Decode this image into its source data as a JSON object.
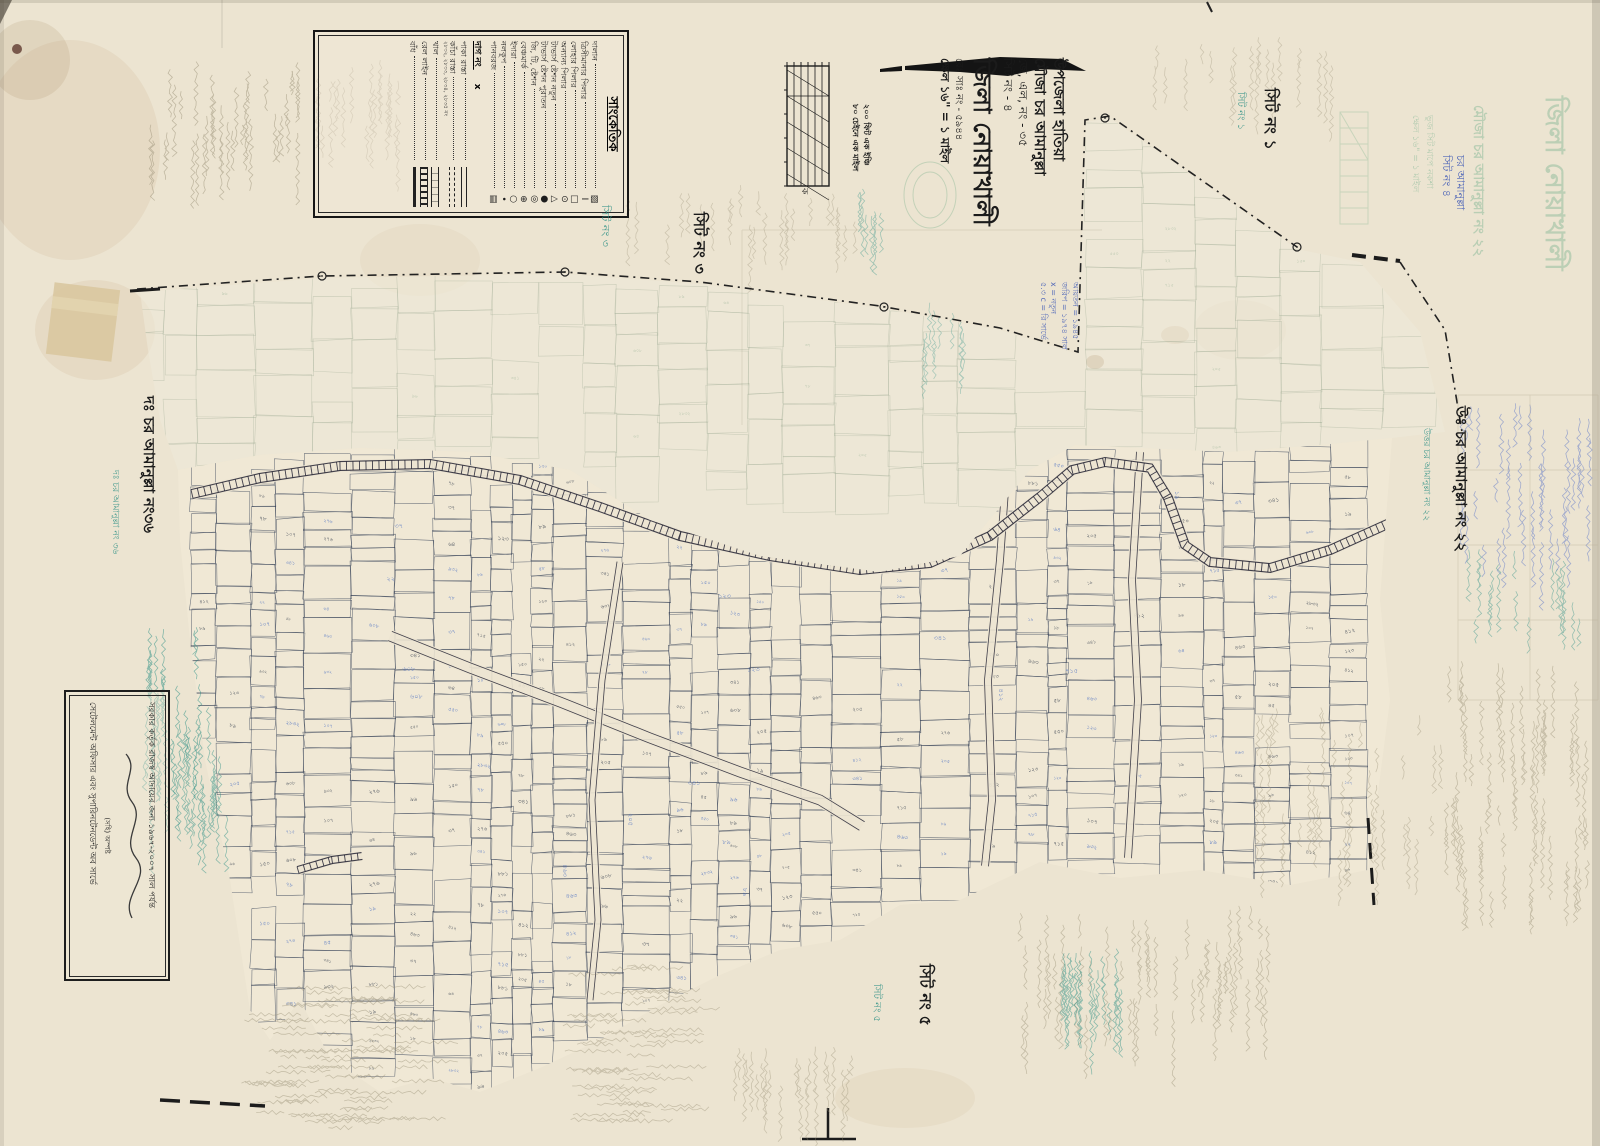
{
  "sheet": {
    "paper_color": "#ece4d1",
    "map_ink_color": "#2e3a52",
    "blue_number_color": "#3e66c0",
    "teal_hand_color": "#2f9186",
    "pencil_color": "#978e74",
    "faint_parcel_color": "#93a48c"
  },
  "legend": {
    "title": "সাংকেতিক",
    "items": [
      {
        "label": "দালান",
        "symbol": "hatched-square"
      },
      {
        "label": "ত্রিসীমানার পিলার",
        "symbol": "bar"
      },
      {
        "label": "লোহার পিলার",
        "symbol": "square"
      },
      {
        "label": "অন্যান্য পিলার",
        "symbol": "circle-dot"
      },
      {
        "label": "টাভার্স ষ্টেশন নতুন",
        "symbol": "triangle"
      },
      {
        "label": "টাভার্স ষ্টেশন পুরাতন",
        "symbol": "bullet"
      },
      {
        "label": "জি, টি, ষ্টেশন",
        "symbol": "double-circle"
      },
      {
        "label": "বেঞ্চমার্ক",
        "symbol": "crossed-circle"
      },
      {
        "label": "ইদারা",
        "symbol": "circle"
      },
      {
        "label": "নলকূপ",
        "symbol": "dot"
      },
      {
        "label": "পানবরজ",
        "symbol": "hatched-rect"
      }
    ],
    "dag_label": "দাগ নং",
    "dag_symbol": "x",
    "line_items": [
      {
        "label": "পাকা রাস্তা",
        "style": "double"
      },
      {
        "label": "কাঁচা রাস্তা",
        "style": "dashed",
        "note": "২৮৩২, ২৮৩৩, ২৮৩৪, ২৮৩৫ নং"
      },
      {
        "label": "খাল",
        "style": "canal"
      },
      {
        "label": "রেল লাইন",
        "style": "rail"
      },
      {
        "label": "বাঁধ",
        "style": "thick"
      }
    ]
  },
  "title_block": {
    "line1": "উপজেলা হাতিয়া",
    "line2": "মৌজা চর আমানুল্লা",
    "line3": "জে, এল, নং - ৩৫",
    "line4": "সিট নং - ৪",
    "line5": "জিলা নোয়াখালী",
    "line6": "রেঃ সাঃ নং - ৫৯৪৪",
    "line7": "ক্ষেল ১৬\" = ১ মাইল"
  },
  "scale_notes": {
    "line1": "২০০ ফিট এক ইঞ্চি",
    "line2": "৮০ চেইনে এক মাইল",
    "letter": "ক"
  },
  "sheet_labels": {
    "sheet1": "সিট নং ১",
    "sheet1_hand": "সিট নং ১",
    "sheet3": "সিট নং ৩",
    "sheet3_hand": "সিট নং ৩",
    "sheet5": "সিট নং ৫",
    "sheet5_hand": "সিট নং ৫"
  },
  "side_labels": {
    "south": "দঃ চর আমানুল্লা নং৩৬",
    "south_hand": "দঃ চর আমানুল্লা নং ৩৬",
    "north": "উঃ চর আমানুল্লা নং ২২",
    "north_hand": "উত্তর চর আমানুল্লা নং ২২"
  },
  "stamp_box": {
    "line1": "সরকার কর্তৃক রাজস্ব আদায়ের জন্য ১৯৬৭-২০০৭ সাল পর্যন্ত",
    "signature": "(সহি) অস্পষ্ট",
    "line2": "সেটেলমেন্ট অফিসার এবং সুপারিনটেনডেন্ট অব সার্ভে"
  },
  "ghost_print": {
    "district": "জিলা নোয়াখালী",
    "mouza": "মৌজা চর আমানুল্লা নং ২২",
    "note1": "ভুজ সিট মাপে নকশা",
    "note2": "ক্ষেল ১৬\" = ১ মাইল"
  },
  "hand_notes": {
    "blue_corner_line1": "চর আমানুল্লা",
    "blue_corner_line2": "সিট নং ৪",
    "blue_title_lines": [
      "আয়তন = ১৯৪৫",
      "জরিপ = ১৯৭৪ সাল",
      "x = নতুন",
      "৫.৩ c = রি সার্ভে"
    ]
  },
  "map": {
    "parcel_digit_samples": [
      "৪৫",
      "১২৩",
      "৭৮",
      "২০৫",
      "৯৬",
      "৩৪১",
      "৫৮",
      "১০৭",
      "২২",
      "৪৬৩",
      "৭১৫",
      "৮৯",
      "১৫০",
      "২৭৬",
      "৬০৮",
      "৯৩২",
      "১৮",
      "৩৭",
      "৫৫০",
      "৪১২",
      "২৮৩২",
      "১৯",
      "৬৪",
      "৮৮১"
    ]
  }
}
